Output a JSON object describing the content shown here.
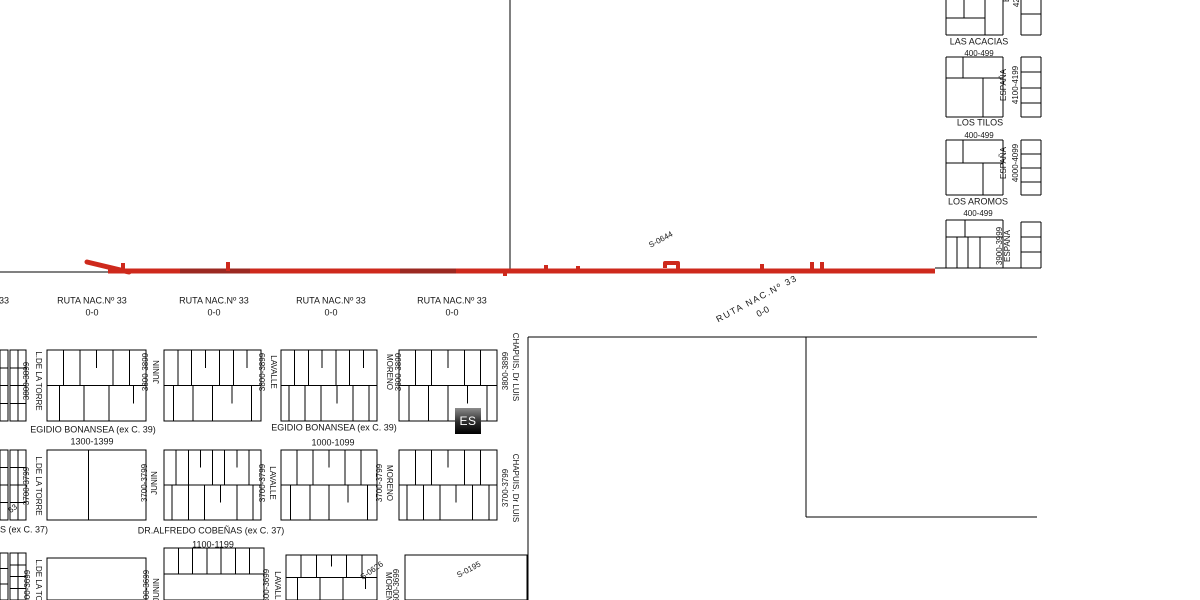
{
  "map": {
    "route": {
      "name": "RUTA NAC.Nº 33",
      "km": "0-0",
      "section_code": "S-0644",
      "color": "#ce291c",
      "dark_color": "#9b2922",
      "width": 5
    },
    "es_marker": {
      "label": "ES"
    },
    "labels": [
      {
        "t": "33",
        "x": 4,
        "y": 301,
        "k": "h",
        "fs": 9,
        "n": "route-label-partial"
      },
      {
        "t": "RUTA NAC.Nº 33",
        "x": 92,
        "y": 301,
        "k": "h",
        "fs": 9,
        "n": "route-label"
      },
      {
        "t": "0-0",
        "x": 92,
        "y": 313,
        "k": "h",
        "fs": 9,
        "n": "route-km-label"
      },
      {
        "t": "RUTA NAC.Nº 33",
        "x": 214,
        "y": 301,
        "k": "h",
        "fs": 9,
        "n": "route-label"
      },
      {
        "t": "0-0",
        "x": 214,
        "y": 313,
        "k": "h",
        "fs": 9,
        "n": "route-km-label"
      },
      {
        "t": "RUTA NAC.Nº 33",
        "x": 331,
        "y": 301,
        "k": "h",
        "fs": 9,
        "n": "route-label"
      },
      {
        "t": "0-0",
        "x": 331,
        "y": 313,
        "k": "h",
        "fs": 9,
        "n": "route-km-label"
      },
      {
        "t": "RUTA NAC.Nº 33",
        "x": 452,
        "y": 301,
        "k": "h",
        "fs": 9,
        "n": "route-label"
      },
      {
        "t": "0-0",
        "x": 452,
        "y": 313,
        "k": "h",
        "fs": 9,
        "n": "route-km-label"
      },
      {
        "t": "S-0644",
        "x": 661,
        "y": 240,
        "k": "d",
        "fs": 8,
        "n": "section-code-label"
      },
      {
        "t": "RUTA NAC.Nº 33",
        "x": 757,
        "y": 299,
        "k": "d",
        "fs": 9,
        "ls": 1.5,
        "n": "route-label"
      },
      {
        "t": "0-0",
        "x": 763,
        "y": 312,
        "k": "d",
        "fs": 9,
        "n": "route-km-label"
      },
      {
        "t": "S-0626",
        "x": 372,
        "y": 571,
        "k": "d2",
        "fs": 8,
        "n": "section-code-label"
      },
      {
        "t": "S-0195",
        "x": 469,
        "y": 570,
        "k": "d",
        "fs": 8,
        "n": "section-code-label"
      },
      {
        "t": "63",
        "x": 13,
        "y": 509,
        "k": "d2",
        "fs": 8,
        "n": "section-code-label-partial"
      },
      {
        "t": "EGIDIO BONANSEA (ex C. 39)",
        "x": 93,
        "y": 430,
        "k": "h",
        "fs": 9,
        "n": "street-name-label"
      },
      {
        "t": "1300-1399",
        "x": 92,
        "y": 442,
        "k": "h",
        "fs": 9,
        "n": "address-range-label"
      },
      {
        "t": "EGIDIO BONANSEA (ex C. 39)",
        "x": 334,
        "y": 428,
        "k": "h",
        "fs": 9,
        "n": "street-name-label"
      },
      {
        "t": "1000-1099",
        "x": 333,
        "y": 443,
        "k": "h",
        "fs": 9,
        "n": "address-range-label"
      },
      {
        "t": "DR.ALFREDO COBEÑAS (ex C. 37)",
        "x": 211,
        "y": 531,
        "k": "h",
        "fs": 9,
        "n": "street-name-label"
      },
      {
        "t": "1100-1199",
        "x": 213,
        "y": 545,
        "k": "h",
        "fs": 9,
        "n": "address-range-label"
      },
      {
        "t": "S (ex C. 37)",
        "x": 24,
        "y": 530,
        "k": "h",
        "fs": 9,
        "n": "street-name-label-partial"
      },
      {
        "t": "LAS ACACIAS",
        "x": 979,
        "y": 42,
        "k": "h",
        "fs": 9,
        "n": "street-name-label"
      },
      {
        "t": "400-499",
        "x": 979,
        "y": 54,
        "k": "h",
        "fs": 8,
        "n": "address-range-label"
      },
      {
        "t": "LOS TILOS",
        "x": 980,
        "y": 123,
        "k": "h",
        "fs": 9,
        "n": "street-name-label"
      },
      {
        "t": "400-499",
        "x": 979,
        "y": 136,
        "k": "h",
        "fs": 8,
        "n": "address-range-label"
      },
      {
        "t": "LOS AROMOS",
        "x": 978,
        "y": 202,
        "k": "h",
        "fs": 9,
        "n": "street-name-label"
      },
      {
        "t": "400-499",
        "x": 978,
        "y": 214,
        "k": "h",
        "fs": 8,
        "n": "address-range-label"
      },
      {
        "t": "L.DE LA TORRE",
        "x": 38,
        "y": 381,
        "k": "v",
        "fs": 8,
        "n": "street-name-label"
      },
      {
        "t": "L.DE LA TORRE",
        "x": 38,
        "y": 486,
        "k": "v",
        "fs": 8,
        "n": "street-name-label"
      },
      {
        "t": "L.DE LA TORRE",
        "x": 38,
        "y": 589,
        "k": "v",
        "fs": 8,
        "n": "street-name-label"
      },
      {
        "t": "JUNIN",
        "x": 157,
        "y": 372,
        "k": "vu",
        "fs": 8,
        "n": "street-name-label"
      },
      {
        "t": "JUNIN",
        "x": 155,
        "y": 483,
        "k": "vu",
        "fs": 8,
        "n": "street-name-label"
      },
      {
        "t": "JUNIN",
        "x": 157,
        "y": 590,
        "k": "vu",
        "fs": 8,
        "n": "street-name-label"
      },
      {
        "t": "LAVALLE",
        "x": 273,
        "y": 372,
        "k": "v",
        "fs": 8,
        "n": "street-name-label"
      },
      {
        "t": "LAVALLE",
        "x": 272,
        "y": 483,
        "k": "v",
        "fs": 8,
        "n": "street-name-label"
      },
      {
        "t": "LAVALLE",
        "x": 277,
        "y": 588,
        "k": "v",
        "fs": 8,
        "n": "street-name-label"
      },
      {
        "t": "MORENO",
        "x": 389,
        "y": 372,
        "k": "v",
        "fs": 8,
        "n": "street-name-label"
      },
      {
        "t": "MORENO",
        "x": 389,
        "y": 483,
        "k": "v",
        "fs": 8,
        "n": "street-name-label"
      },
      {
        "t": "MORENO",
        "x": 388,
        "y": 590,
        "k": "v",
        "fs": 8,
        "n": "street-name-label"
      },
      {
        "t": "CHAPUIS, Dr LUIS",
        "x": 515,
        "y": 367,
        "k": "v",
        "fs": 8,
        "n": "street-name-label"
      },
      {
        "t": "CHAPUIS, Dr LUIS",
        "x": 515,
        "y": 488,
        "k": "v",
        "fs": 8,
        "n": "street-name-label"
      },
      {
        "t": "ESPAÑA",
        "x": 1004,
        "y": 85,
        "k": "vu",
        "fs": 8,
        "n": "street-name-label"
      },
      {
        "t": "ESPAÑA",
        "x": 1004,
        "y": 163,
        "k": "vu",
        "fs": 8,
        "n": "street-name-label"
      },
      {
        "t": "ESPAÑA",
        "x": 1008,
        "y": 246,
        "k": "vu",
        "fs": 8,
        "n": "street-name-label"
      },
      {
        "t": "ESPAÑA",
        "x": 1007,
        "y": -14,
        "k": "vu",
        "fs": 8,
        "n": "street-name-label-partial"
      },
      {
        "t": "3800-3899",
        "x": 27,
        "y": 381,
        "k": "vu",
        "fs": 8,
        "n": "address-range-label"
      },
      {
        "t": "3700-3799",
        "x": 27,
        "y": 486,
        "k": "vu",
        "fs": 8,
        "n": "address-range-label"
      },
      {
        "t": "3600-3699",
        "x": 28,
        "y": 589,
        "k": "vu",
        "fs": 8,
        "n": "address-range-label"
      },
      {
        "t": "3800-3899",
        "x": 146,
        "y": 372,
        "k": "vu",
        "fs": 8,
        "n": "address-range-label"
      },
      {
        "t": "3700-3799",
        "x": 145,
        "y": 483,
        "k": "vu",
        "fs": 8,
        "n": "address-range-label"
      },
      {
        "t": "3600-3699",
        "x": 147,
        "y": 589,
        "k": "vu",
        "fs": 8,
        "n": "address-range-label"
      },
      {
        "t": "3800-3899",
        "x": 263,
        "y": 372,
        "k": "vu",
        "fs": 8,
        "n": "address-range-label"
      },
      {
        "t": "3700-3799",
        "x": 263,
        "y": 483,
        "k": "vu",
        "fs": 8,
        "n": "address-range-label"
      },
      {
        "t": "3600-3699",
        "x": 267,
        "y": 588,
        "k": "vu",
        "fs": 8,
        "n": "address-range-label"
      },
      {
        "t": "3800-3899",
        "x": 399,
        "y": 372,
        "k": "vu",
        "fs": 8,
        "n": "address-range-label"
      },
      {
        "t": "3700-3799",
        "x": 380,
        "y": 483,
        "k": "vu",
        "fs": 8,
        "n": "address-range-label"
      },
      {
        "t": "3600-3699",
        "x": 397,
        "y": 588,
        "k": "vu",
        "fs": 8,
        "n": "address-range-label"
      },
      {
        "t": "3800-3899",
        "x": 506,
        "y": 371,
        "k": "vu",
        "fs": 8,
        "n": "address-range-label"
      },
      {
        "t": "3700-3799",
        "x": 506,
        "y": 488,
        "k": "vu",
        "fs": 8,
        "n": "address-range-label"
      },
      {
        "t": "4100-4199",
        "x": 1016,
        "y": 85,
        "k": "vu",
        "fs": 8,
        "n": "address-range-label"
      },
      {
        "t": "4000-4099",
        "x": 1016,
        "y": 163,
        "k": "vu",
        "fs": 8,
        "n": "address-range-label"
      },
      {
        "t": "3900-3999",
        "x": 1000,
        "y": 246,
        "k": "vu",
        "fs": 8,
        "n": "address-range-label"
      },
      {
        "t": "4200-4299",
        "x": 1017,
        "y": -12,
        "k": "vu",
        "fs": 8,
        "n": "address-range-label-partial"
      }
    ],
    "geometry": {
      "lines": [
        [
          946,
          0,
          946,
          35
        ],
        [
          946,
          57,
          946,
          117
        ],
        [
          946,
          140,
          946,
          195
        ],
        [
          946,
          220,
          946,
          268
        ],
        [
          1003,
          0,
          1003,
          35
        ],
        [
          1003,
          57,
          1003,
          117
        ],
        [
          1003,
          140,
          1003,
          195
        ],
        [
          1003,
          220,
          1003,
          268
        ],
        [
          946,
          35,
          1003,
          35
        ],
        [
          946,
          57,
          1003,
          57
        ],
        [
          946,
          117,
          1003,
          117
        ],
        [
          946,
          140,
          1003,
          140
        ],
        [
          946,
          195,
          1003,
          195
        ],
        [
          946,
          220,
          1003,
          220
        ],
        [
          964,
          0,
          964,
          18
        ],
        [
          985,
          0,
          985,
          35
        ],
        [
          946,
          18,
          985,
          18
        ],
        [
          963,
          57,
          963,
          78
        ],
        [
          946,
          78,
          1003,
          78
        ],
        [
          983,
          78,
          983,
          117
        ],
        [
          946,
          163,
          1003,
          163
        ],
        [
          963,
          140,
          963,
          163
        ],
        [
          983,
          163,
          983,
          195
        ],
        [
          946,
          237,
          1003,
          237
        ],
        [
          957,
          237,
          957,
          268
        ],
        [
          968,
          237,
          968,
          268
        ],
        [
          980,
          237,
          980,
          268
        ],
        [
          965,
          220,
          965,
          237
        ],
        [
          935,
          268,
          1041,
          268
        ],
        [
          1021,
          0,
          1021,
          35
        ],
        [
          1041,
          0,
          1041,
          35
        ],
        [
          1021,
          14,
          1041,
          14
        ],
        [
          1021,
          35,
          1041,
          35
        ],
        [
          1021,
          57,
          1021,
          117
        ],
        [
          1041,
          57,
          1041,
          117
        ],
        [
          1021,
          57,
          1041,
          57
        ],
        [
          1021,
          117,
          1041,
          117
        ],
        [
          1021,
          72,
          1041,
          72
        ],
        [
          1021,
          88,
          1041,
          88
        ],
        [
          1021,
          103,
          1041,
          103
        ],
        [
          1021,
          140,
          1021,
          195
        ],
        [
          1041,
          140,
          1041,
          195
        ],
        [
          1021,
          140,
          1041,
          140
        ],
        [
          1021,
          195,
          1041,
          195
        ],
        [
          1021,
          154,
          1041,
          154
        ],
        [
          1021,
          168,
          1041,
          168
        ],
        [
          1021,
          182,
          1041,
          182
        ],
        [
          1021,
          222,
          1021,
          268
        ],
        [
          1041,
          222,
          1041,
          268
        ],
        [
          1021,
          222,
          1041,
          222
        ],
        [
          1021,
          237,
          1041,
          237
        ],
        [
          1021,
          252,
          1041,
          252
        ],
        [
          510,
          0,
          510,
          269
        ],
        [
          0,
          272,
          110,
          272
        ],
        [
          528,
          337,
          1037,
          337
        ],
        [
          528,
          337,
          528,
          600
        ],
        [
          806,
          337,
          806,
          517
        ],
        [
          806,
          517,
          1037,
          517
        ]
      ],
      "blocks": [
        {
          "x": 0,
          "y": 350,
          "w": 8,
          "h": 71,
          "p": "h3"
        },
        {
          "x": 10,
          "y": 350,
          "w": 16,
          "h": 71,
          "p": "grid"
        },
        {
          "x": 47,
          "y": 350,
          "w": 99,
          "h": 71,
          "p": "comb",
          "t": 5,
          "b": 4
        },
        {
          "x": 164,
          "y": 350,
          "w": 97,
          "h": 71,
          "p": "comb",
          "t": 6,
          "b": 5
        },
        {
          "x": 281,
          "y": 350,
          "w": 96,
          "h": 71,
          "p": "comb",
          "t": 6,
          "b": 6
        },
        {
          "x": 399,
          "y": 350,
          "w": 98,
          "h": 71,
          "p": "comb",
          "t": 5,
          "b": 5
        },
        {
          "x": 0,
          "y": 450,
          "w": 8,
          "h": 70,
          "p": "h3"
        },
        {
          "x": 10,
          "y": 450,
          "w": 16,
          "h": 70,
          "p": "grid"
        },
        {
          "x": 47,
          "y": 450,
          "w": 99,
          "h": 70,
          "p": "v1"
        },
        {
          "x": 164,
          "y": 450,
          "w": 97,
          "h": 70,
          "p": "comb",
          "t": 7,
          "b": 6
        },
        {
          "x": 281,
          "y": 450,
          "w": 96,
          "h": 70,
          "p": "comb",
          "t": 5,
          "b": 5
        },
        {
          "x": 399,
          "y": 450,
          "w": 98,
          "h": 70,
          "p": "comb",
          "t": 5,
          "b": 6
        },
        {
          "x": 0,
          "y": 553,
          "w": 8,
          "h": 47,
          "p": "h2"
        },
        {
          "x": 10,
          "y": 553,
          "w": 16,
          "h": 47,
          "p": "grid"
        },
        {
          "x": 47,
          "y": 558,
          "w": 99,
          "h": 42,
          "p": "empty"
        },
        {
          "x": 164,
          "y": 548,
          "w": 100,
          "h": 52,
          "p": "combt",
          "t": 6
        },
        {
          "x": 286,
          "y": 555,
          "w": 91,
          "h": 45,
          "p": "comb",
          "t": 5,
          "b": 4
        },
        {
          "x": 405,
          "y": 555,
          "w": 122,
          "h": 45,
          "p": "empty"
        }
      ],
      "route_shape": {
        "main": [
          108,
          271,
          935,
          271
        ],
        "diag": [
          87,
          262,
          129,
          272
        ],
        "ticks": [
          [
            123,
            263
          ],
          [
            228,
            262
          ],
          [
            546,
            265
          ],
          [
            578,
            266
          ],
          [
            762,
            264
          ],
          [
            812,
            262
          ],
          [
            822,
            262
          ]
        ],
        "down_ticks": [
          [
            505,
            276
          ]
        ],
        "hook": "M678,271 L678,263 L665,263 L665,268",
        "dark_segments": [
          [
            180,
            250
          ],
          [
            400,
            456
          ]
        ]
      }
    }
  }
}
